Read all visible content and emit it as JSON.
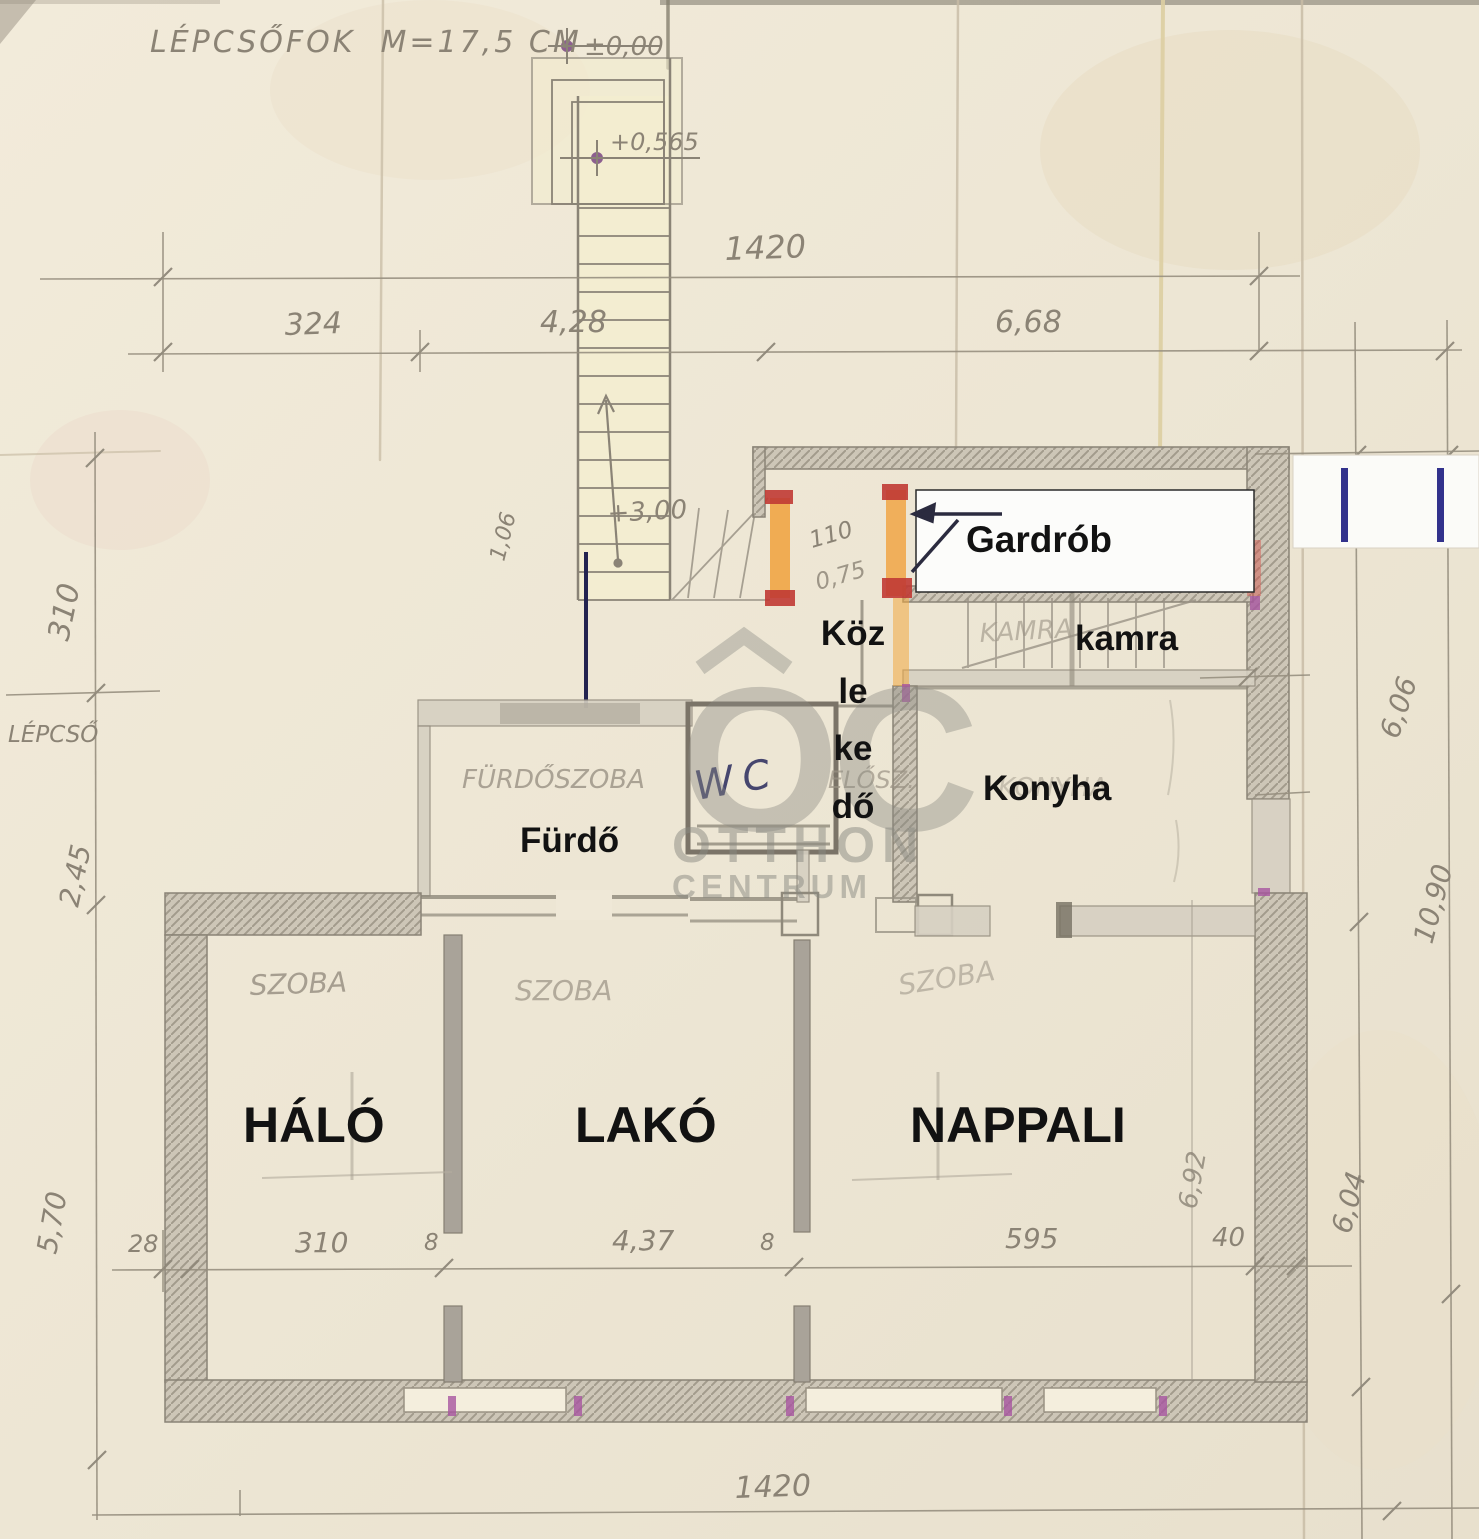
{
  "notes": {
    "stair_note": "LÉPCSŐFOK  M=17,5 CM"
  },
  "levels": {
    "ground": "±0,00",
    "landing": "+0,565",
    "mid_flight": "+3,00"
  },
  "rooms": {
    "gardrob": "Gardrób",
    "kamra": "kamra",
    "kozlekedo": [
      "Köz",
      "le",
      "ke",
      "dő"
    ],
    "konyha": "Konyha",
    "furdo": "Fürdő",
    "halo": "HÁLÓ",
    "lako": "LAKÓ",
    "nappali": "NAPPALI",
    "wc": "WC"
  },
  "handwritten": {
    "szoba": "SZOBA",
    "furdoszoba": "FÜRDŐSZOBA",
    "elosz": "ELŐSZ.",
    "kamra": "KAMRA",
    "konyha": "KONYHA",
    "lepcso": "LÉPCSŐ"
  },
  "dimensions": {
    "top_total": "1420",
    "top_segments": [
      "324",
      "4,28",
      "6,68"
    ],
    "left": [
      "310",
      "2,45",
      "5,70"
    ],
    "bottom": [
      "28",
      "310",
      "8",
      "4,37",
      "8",
      "595",
      "40"
    ],
    "bottom_total": "1420",
    "right": [
      "6,06",
      "10,90",
      "6,92",
      "6,04"
    ],
    "small": [
      "1,06",
      "110",
      "0,75"
    ]
  },
  "watermark": {
    "monogram": "OC",
    "line1": "OTTHON",
    "line2": "CENTRUM"
  },
  "colors": {
    "paper": "#efe8d7",
    "pencil": "#8f887a",
    "highlight_orange": "#f0a13c",
    "highlight_red": "#c03a34",
    "ink_blue": "#32328c",
    "label_black": "#111111"
  }
}
